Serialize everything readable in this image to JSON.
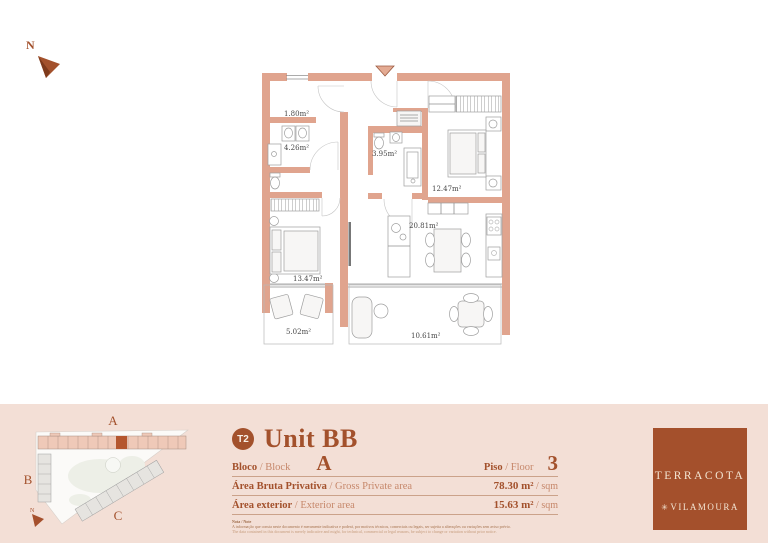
{
  "colors": {
    "accent_dark": "#A3512C",
    "accent_light": "#C6876A",
    "wall_fill": "#E0A48E",
    "band_bg": "#F3DFD6",
    "logo_bg": "#A4502C",
    "logo_text": "#F3E5D3"
  },
  "north": {
    "label": "N"
  },
  "floor_plan": {
    "rooms": [
      {
        "name": "closet",
        "area": "1.80m²"
      },
      {
        "name": "bathroom-1",
        "area": "4.26m²"
      },
      {
        "name": "bathroom-2",
        "area": "3.95m²"
      },
      {
        "name": "bedroom-1",
        "area": "12.47m²"
      },
      {
        "name": "living-dining",
        "area": "20.81m²"
      },
      {
        "name": "bedroom-2",
        "area": "13.47m²"
      },
      {
        "name": "balcony-1",
        "area": "5.02m²"
      },
      {
        "name": "balcony-2",
        "area": "10.61m²"
      }
    ]
  },
  "site_plan": {
    "block_a": "A",
    "block_b": "B",
    "block_c": "C",
    "north_label": "N"
  },
  "info": {
    "type_badge": "T2",
    "unit_title": "Unit BB",
    "block_label_pt": "Bloco",
    "block_label_en": " / Block",
    "block_value": "A",
    "floor_label_pt": "Piso",
    "floor_label_en": " / Floor",
    "floor_value": "3",
    "gross_label_pt": "Área Bruta Privativa",
    "gross_label_en": " / Gross Private area",
    "gross_value": "78.30 m²",
    "gross_unit": " / sqm",
    "ext_label_pt": "Área exterior",
    "ext_label_en": " / Exterior area",
    "ext_value": "15.63 m²",
    "ext_unit": " / sqm",
    "disclaimer_title": "Nota / Note",
    "disclaimer_pt": "A informação que consta neste documento é meramente indicativa e poderá, por motivos técnicos, comerciais ou legais, ser sujeita a alterações ou variações sem aviso prévio.",
    "disclaimer_en": "The data contained in this document is merely indicative and might, for technical, commercial or legal reasons, be subject to change or variation without prior notice."
  },
  "logo": {
    "brand": "TERRACOTA",
    "mark": "✳",
    "location": "VILAMOURA"
  }
}
